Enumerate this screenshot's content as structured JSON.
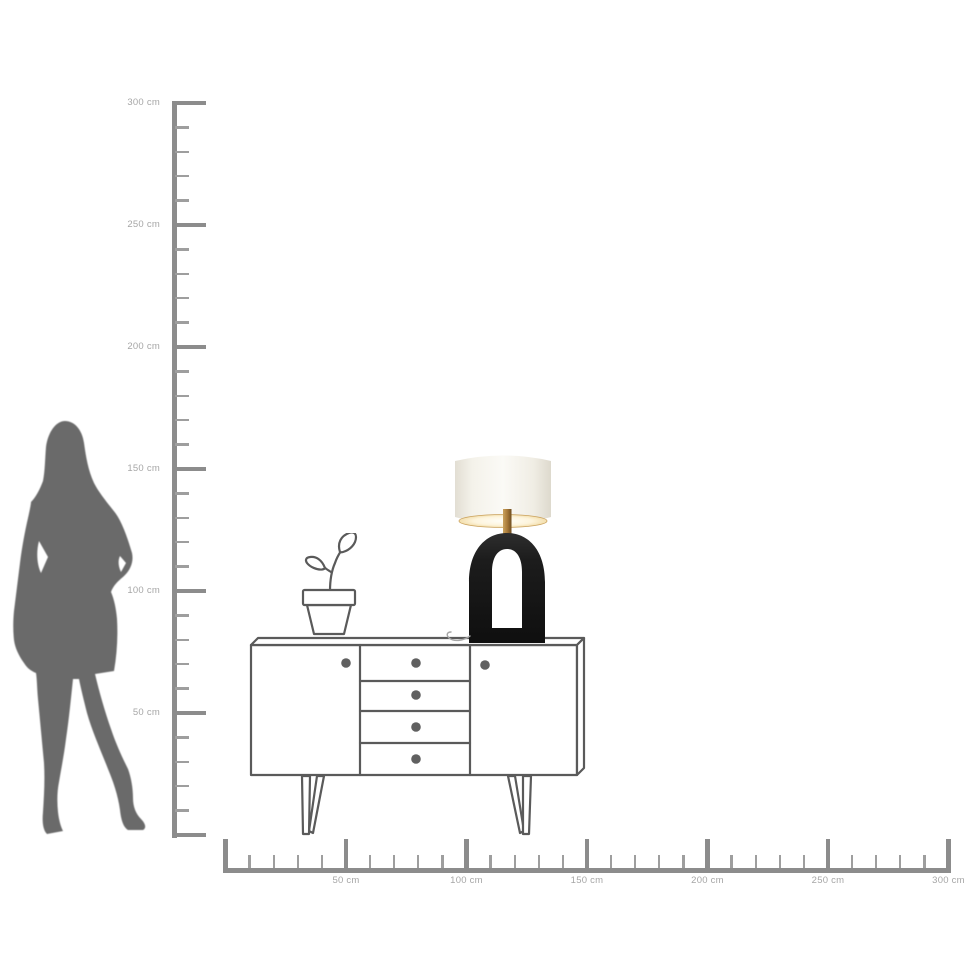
{
  "colors": {
    "background": "#ffffff",
    "ruler": "#8c8c8c",
    "ruler-minor": "#9e9e9e",
    "ruler-label": "#a6a6a6",
    "outline": "#5a5a5a",
    "knob": "#606060",
    "silhouette": "#6a6a6a",
    "lamp-shade": "#f6f4ee",
    "lamp-shade-edge": "#e0dcd1",
    "lamp-glow": "#fdf4dc",
    "lamp-glow-rim": "#caa25e",
    "lamp-base": "#161616",
    "lamp-stem": "#a87a3a",
    "cord": "#a6a6a6"
  },
  "vertical_ruler": {
    "unit": "cm",
    "min_cm": 0,
    "max_cm": 300,
    "minor_step_cm": 10,
    "major_step_cm": 50,
    "labels": [
      {
        "cm": 300,
        "text": "300 cm"
      },
      {
        "cm": 250,
        "text": "250 cm"
      },
      {
        "cm": 200,
        "text": "200 cm"
      },
      {
        "cm": 150,
        "text": "150 cm"
      },
      {
        "cm": 100,
        "text": "100 cm"
      },
      {
        "cm": 50,
        "text": "50 cm"
      }
    ]
  },
  "horizontal_ruler": {
    "unit": "cm",
    "min_cm": 0,
    "max_cm": 300,
    "minor_step_cm": 10,
    "major_step_cm": 50,
    "labels": [
      {
        "cm": 50,
        "text": "50 cm"
      },
      {
        "cm": 100,
        "text": "100 cm"
      },
      {
        "cm": 150,
        "text": "150 cm"
      },
      {
        "cm": 200,
        "text": "200 cm"
      },
      {
        "cm": 250,
        "text": "250 cm"
      },
      {
        "cm": 300,
        "text": "300 cm"
      }
    ]
  },
  "figures": {
    "person": "woman silhouette for scale",
    "sideboard": {
      "doors": 2,
      "drawers": 4,
      "knobs": 6
    },
    "plant": "potted plant sketch",
    "lamp": {
      "shade": "white drum shade",
      "base": "black arch base"
    }
  }
}
